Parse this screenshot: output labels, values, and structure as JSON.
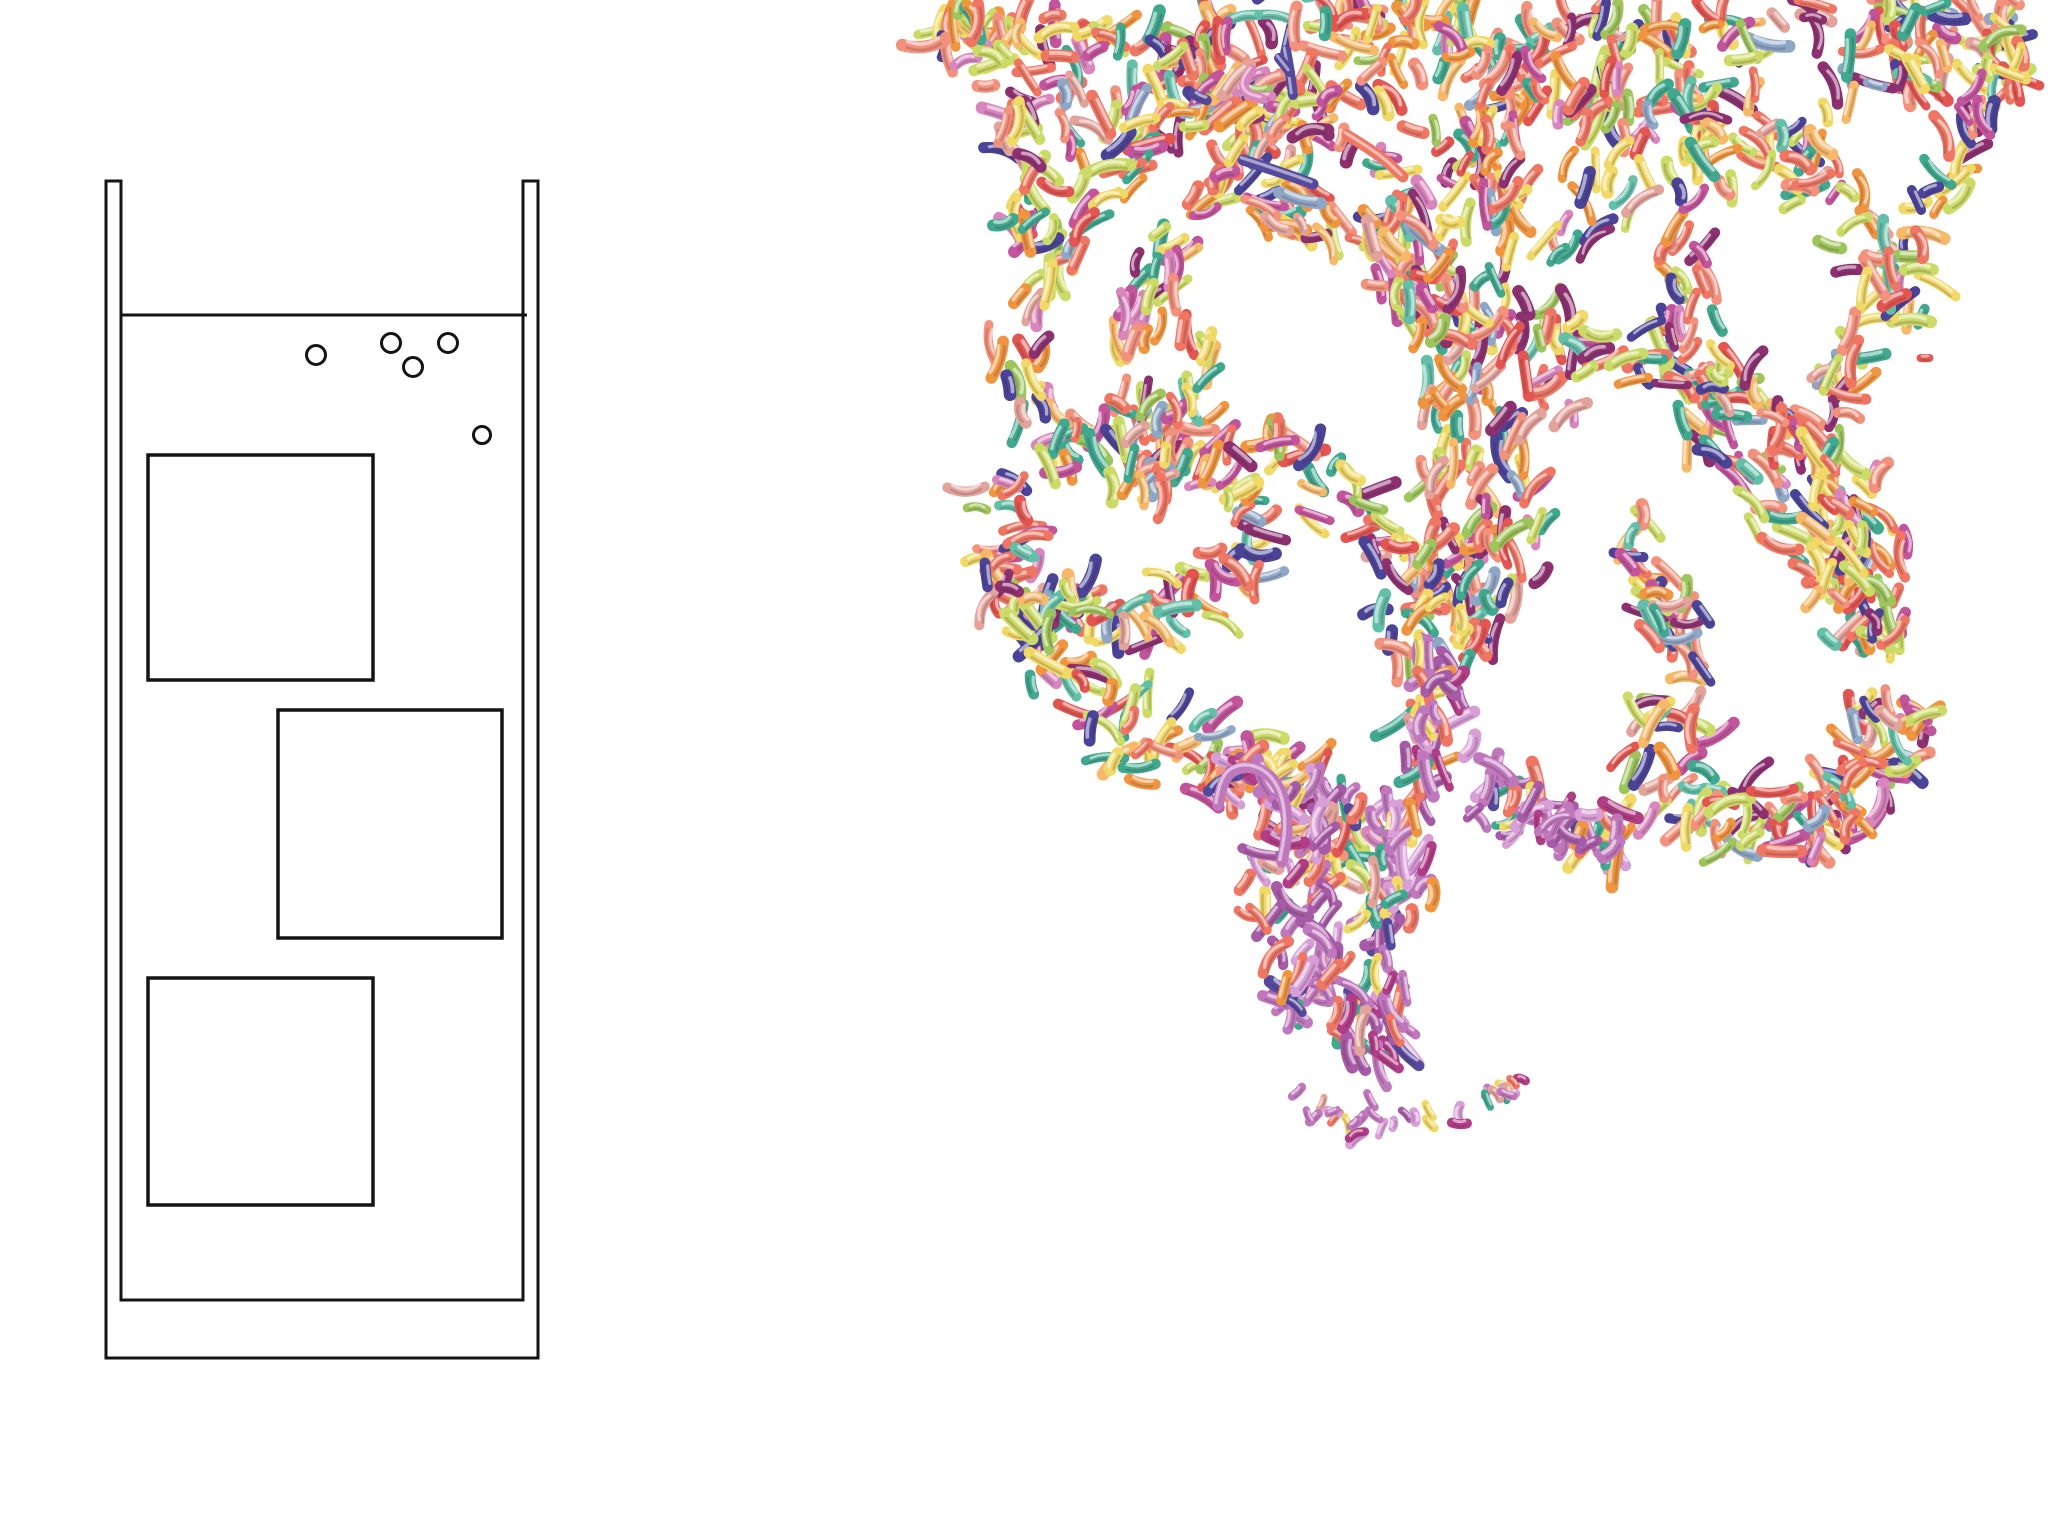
{
  "canvas": {
    "width": 2048,
    "height": 1536,
    "background": "#ffffff"
  },
  "schematic": {
    "line_color": "#141414",
    "wall": {
      "outer_left": 106,
      "inner_left": 121,
      "outer_right": 538,
      "inner_right": 523,
      "top": 181,
      "outer_bottom": 1358,
      "inner_bottom": 1300,
      "stroke_width": 3
    },
    "water_line": {
      "x1": 121,
      "x2": 527,
      "y": 315,
      "stroke_width": 3
    },
    "bubbles": [
      {
        "cx": 316,
        "cy": 355,
        "r": 9.5
      },
      {
        "cx": 391,
        "cy": 343,
        "r": 9.5
      },
      {
        "cx": 413,
        "cy": 367,
        "r": 9.5
      },
      {
        "cx": 448,
        "cy": 343,
        "r": 9.5
      },
      {
        "cx": 482,
        "cy": 435,
        "r": 8.5
      }
    ],
    "bubble_stroke_width": 3,
    "windows": [
      {
        "x": 148,
        "y": 455,
        "w": 225,
        "h": 225
      },
      {
        "x": 278,
        "y": 710,
        "w": 224,
        "h": 228
      },
      {
        "x": 148,
        "y": 978,
        "w": 225,
        "h": 227
      }
    ],
    "window_stroke_width": 3.5
  },
  "plume": {
    "seed": 7,
    "particle": {
      "len": [
        16,
        44
      ],
      "wid": [
        8.5,
        13
      ]
    },
    "highlight_opacity": 0.55,
    "shade_color": "#3a2430",
    "shade_opacity": 0.2,
    "palette_main": [
      {
        "c": "#ee7663",
        "w": 14
      },
      {
        "c": "#f2917c",
        "w": 8
      },
      {
        "c": "#e25550",
        "w": 5
      },
      {
        "c": "#f0953f",
        "w": 9
      },
      {
        "c": "#f6b96a",
        "w": 4
      },
      {
        "c": "#f0d967",
        "w": 12
      },
      {
        "c": "#ccdb67",
        "w": 10
      },
      {
        "c": "#9ec45c",
        "w": 4
      },
      {
        "c": "#3fa88e",
        "w": 9
      },
      {
        "c": "#63bfa8",
        "w": 4
      },
      {
        "c": "#4a4397",
        "w": 7
      },
      {
        "c": "#8c3070",
        "w": 7
      },
      {
        "c": "#c2549b",
        "w": 7
      },
      {
        "c": "#d886bd",
        "w": 4
      },
      {
        "c": "#e2a39a",
        "w": 3
      },
      {
        "c": "#8fa7c6",
        "w": 3
      }
    ],
    "palette_tail": [
      {
        "c": "#c078bd",
        "w": 20
      },
      {
        "c": "#a75aa5",
        "w": 10
      },
      {
        "c": "#d89ed6",
        "w": 10
      },
      {
        "c": "#ee7663",
        "w": 10
      },
      {
        "c": "#b03d85",
        "w": 8
      },
      {
        "c": "#3fa88e",
        "w": 6
      },
      {
        "c": "#f0d967",
        "w": 5
      },
      {
        "c": "#54499b",
        "w": 5
      },
      {
        "c": "#f0953f",
        "w": 4
      },
      {
        "c": "#e2a39a",
        "w": 4
      }
    ],
    "strokes": [
      {
        "name": "canopy-top",
        "pts": [
          [
            925,
            28
          ],
          [
            1150,
            38
          ],
          [
            1400,
            22
          ],
          [
            1700,
            34
          ],
          [
            2020,
            26
          ]
        ],
        "n": 200,
        "spread": 38,
        "align": 0.35
      },
      {
        "name": "canopy-second",
        "pts": [
          [
            960,
            75
          ],
          [
            1200,
            92
          ],
          [
            1430,
            72
          ],
          [
            1620,
            98
          ],
          [
            1900,
            82
          ],
          [
            2022,
            62
          ]
        ],
        "n": 150,
        "spread": 40,
        "align": 0.35
      },
      {
        "name": "canopy-fringe",
        "pts": [
          [
            1000,
            142
          ],
          [
            1180,
            132
          ],
          [
            1350,
            152
          ],
          [
            1500,
            162
          ]
        ],
        "n": 55,
        "spread": 45,
        "align": 0.4
      },
      {
        "name": "right-fringe",
        "pts": [
          [
            1720,
            95
          ],
          [
            1800,
            165
          ],
          [
            1870,
            245
          ],
          [
            1915,
            325
          ]
        ],
        "n": 55,
        "spread": 48,
        "align": 0.55
      },
      {
        "name": "right-edge-descent",
        "pts": [
          [
            1985,
            85
          ],
          [
            1930,
            205
          ],
          [
            1872,
            305
          ],
          [
            1832,
            385
          ]
        ],
        "n": 40,
        "spread": 30,
        "align": 0.6
      },
      {
        "name": "trunk-left",
        "pts": [
          [
            1520,
            60
          ],
          [
            1500,
            200
          ],
          [
            1468,
            350
          ],
          [
            1452,
            480
          ],
          [
            1440,
            610
          ]
        ],
        "n": 110,
        "spread": 55,
        "align": 0.75
      },
      {
        "name": "trunk-mid",
        "pts": [
          [
            1625,
            80
          ],
          [
            1592,
            220
          ],
          [
            1542,
            380
          ],
          [
            1502,
            520
          ],
          [
            1472,
            645
          ]
        ],
        "n": 100,
        "spread": 50,
        "align": 0.75
      },
      {
        "name": "trunk-right",
        "pts": [
          [
            1700,
            150
          ],
          [
            1682,
            300
          ],
          [
            1705,
            420
          ],
          [
            1782,
            505
          ],
          [
            1852,
            585
          ]
        ],
        "n": 80,
        "spread": 45,
        "align": 0.7
      },
      {
        "name": "right-arch",
        "pts": [
          [
            1560,
            330
          ],
          [
            1680,
            362
          ],
          [
            1800,
            432
          ],
          [
            1868,
            542
          ],
          [
            1880,
            652
          ]
        ],
        "n": 70,
        "spread": 40,
        "align": 0.7
      },
      {
        "name": "right-basket",
        "pts": [
          [
            1645,
            705
          ],
          [
            1700,
            800
          ],
          [
            1792,
            832
          ],
          [
            1868,
            782
          ],
          [
            1898,
            705
          ]
        ],
        "n": 120,
        "spread": 55,
        "align": 0.25
      },
      {
        "name": "curl-inner",
        "pts": [
          [
            1622,
            520
          ],
          [
            1660,
            600
          ],
          [
            1700,
            670
          ]
        ],
        "n": 35,
        "spread": 35,
        "align": 0.6
      },
      {
        "name": "swan-neck",
        "pts": [
          [
            1272,
            78
          ],
          [
            1180,
            122
          ],
          [
            1082,
            222
          ],
          [
            1022,
            332
          ],
          [
            1032,
            432
          ]
        ],
        "n": 70,
        "spread": 34,
        "align": 0.78
      },
      {
        "name": "swan-neck-2",
        "pts": [
          [
            1332,
            92
          ],
          [
            1242,
            162
          ],
          [
            1162,
            262
          ],
          [
            1122,
            362
          ]
        ],
        "n": 50,
        "spread": 30,
        "align": 0.78
      },
      {
        "name": "claw-loop",
        "pts": [
          [
            1042,
            452
          ],
          [
            1122,
            422
          ],
          [
            1222,
            462
          ],
          [
            1252,
            542
          ],
          [
            1182,
            602
          ],
          [
            1082,
            612
          ],
          [
            1012,
            562
          ],
          [
            1002,
            482
          ]
        ],
        "n": 130,
        "spread": 45,
        "align": 0.3
      },
      {
        "name": "claw-hook",
        "pts": [
          [
            1002,
            562
          ],
          [
            1032,
            642
          ],
          [
            1092,
            692
          ]
        ],
        "n": 35,
        "spread": 35,
        "align": 0.5
      },
      {
        "name": "below-claw",
        "pts": [
          [
            1102,
            702
          ],
          [
            1202,
            762
          ],
          [
            1302,
            802
          ],
          [
            1382,
            852
          ]
        ],
        "n": 80,
        "spread": 55,
        "align": 0.35
      },
      {
        "name": "mid-connector",
        "pts": [
          [
            1282,
            422
          ],
          [
            1352,
            502
          ],
          [
            1402,
            582
          ],
          [
            1432,
            662
          ]
        ],
        "n": 50,
        "spread": 50,
        "align": 0.5
      },
      {
        "name": "tail-main",
        "pts": [
          [
            1452,
            652
          ],
          [
            1422,
            762
          ],
          [
            1392,
            882
          ],
          [
            1372,
            992
          ],
          [
            1392,
            1062
          ]
        ],
        "n": 110,
        "spread": 48,
        "align": 0.7,
        "palette": "tail"
      },
      {
        "name": "tail-left",
        "pts": [
          [
            1332,
            782
          ],
          [
            1312,
            882
          ],
          [
            1322,
            982
          ],
          [
            1352,
            1052
          ]
        ],
        "n": 60,
        "spread": 35,
        "align": 0.7,
        "palette": "tail"
      },
      {
        "name": "tail-scatter",
        "pts": [
          [
            1292,
            1102
          ],
          [
            1382,
            1122
          ],
          [
            1472,
            1112
          ],
          [
            1522,
            1082
          ]
        ],
        "n": 32,
        "spread": 22,
        "align": 0.25,
        "palette": "tail",
        "len": [
          8,
          18
        ],
        "wid": [
          7,
          10
        ]
      },
      {
        "name": "tail-right-cluster",
        "pts": [
          [
            1482,
            782
          ],
          [
            1562,
            832
          ],
          [
            1622,
            842
          ]
        ],
        "n": 55,
        "spread": 45,
        "align": 0.3,
        "palette": "tail"
      },
      {
        "name": "hook-halo",
        "pts": [
          [
            1218,
            800
          ],
          [
            1250,
            766
          ],
          [
            1285,
            795
          ],
          [
            1288,
            845
          ]
        ],
        "n": 22,
        "spread": 18,
        "align": 0.4,
        "palette": "tail"
      },
      {
        "name": "neck-feed",
        "pts": [
          [
            1262,
            202
          ],
          [
            1382,
            262
          ],
          [
            1452,
            332
          ]
        ],
        "n": 45,
        "spread": 40,
        "align": 0.7
      },
      {
        "name": "claw-top-verticals",
        "pts": [
          [
            1185,
            332
          ],
          [
            1175,
            422
          ],
          [
            1152,
            502
          ]
        ],
        "n": 40,
        "spread": 45,
        "align": 0.75
      },
      {
        "name": "right-flow",
        "pts": [
          [
            1782,
            352
          ],
          [
            1822,
            452
          ],
          [
            1852,
            552
          ],
          [
            1862,
            642
          ]
        ],
        "n": 60,
        "spread": 50,
        "align": 0.7
      },
      {
        "name": "tail-left-sparse",
        "pts": [
          [
            1255,
            852
          ],
          [
            1272,
            952
          ],
          [
            1302,
            1022
          ]
        ],
        "n": 22,
        "spread": 25,
        "align": 0.6,
        "palette": "tail"
      },
      {
        "name": "canopy-wisp",
        "pts": [
          [
            1012,
            122
          ],
          [
            1036,
            192
          ],
          [
            1022,
            236
          ]
        ],
        "n": 22,
        "spread": 26,
        "align": 0.6
      },
      {
        "name": "trunk-top-feed",
        "pts": [
          [
            1392,
            202
          ],
          [
            1432,
            282
          ],
          [
            1452,
            342
          ]
        ],
        "n": 40,
        "spread": 50,
        "align": 0.6
      }
    ],
    "tubes": [
      {
        "name": "indigo-diagonal",
        "pts": [
          [
            1243,
            160
          ],
          [
            1280,
            172
          ],
          [
            1313,
            184
          ]
        ],
        "w": 11,
        "color": "#54499b"
      },
      {
        "name": "coral-diagonal",
        "pts": [
          [
            1347,
            135
          ],
          [
            1380,
            155
          ],
          [
            1403,
            177
          ]
        ],
        "w": 11,
        "color": "#ee7663"
      },
      {
        "name": "orchid-hook",
        "pts": [
          [
            1218,
            805
          ],
          [
            1222,
            778
          ],
          [
            1243,
            765
          ],
          [
            1268,
            772
          ],
          [
            1284,
            795
          ],
          [
            1288,
            830
          ],
          [
            1282,
            862
          ]
        ],
        "w": 11.5,
        "color": "#c078bd"
      },
      {
        "name": "indigo-y-stem",
        "pts": [
          [
            1286,
            50
          ],
          [
            1290,
            72
          ],
          [
            1293,
            95
          ]
        ],
        "w": 10,
        "color": "#54499b"
      },
      {
        "name": "indigo-y-branch",
        "pts": [
          [
            1279,
            58
          ],
          [
            1290,
            72
          ]
        ],
        "w": 10,
        "color": "#54499b"
      },
      {
        "name": "pink-c-curl",
        "pts": [
          [
            1252,
            70
          ],
          [
            1242,
            82
          ],
          [
            1247,
            95
          ],
          [
            1262,
            99
          ]
        ],
        "w": 10,
        "color": "#d886bd"
      }
    ],
    "accents": [
      {
        "x": 1925,
        "y": 358,
        "angle": 0,
        "len": 9,
        "wid": 8,
        "color": "#e25550"
      },
      {
        "x": 1200,
        "y": 97,
        "angle": 0.44,
        "len": 15,
        "wid": 10,
        "color": "#54499b"
      }
    ]
  }
}
